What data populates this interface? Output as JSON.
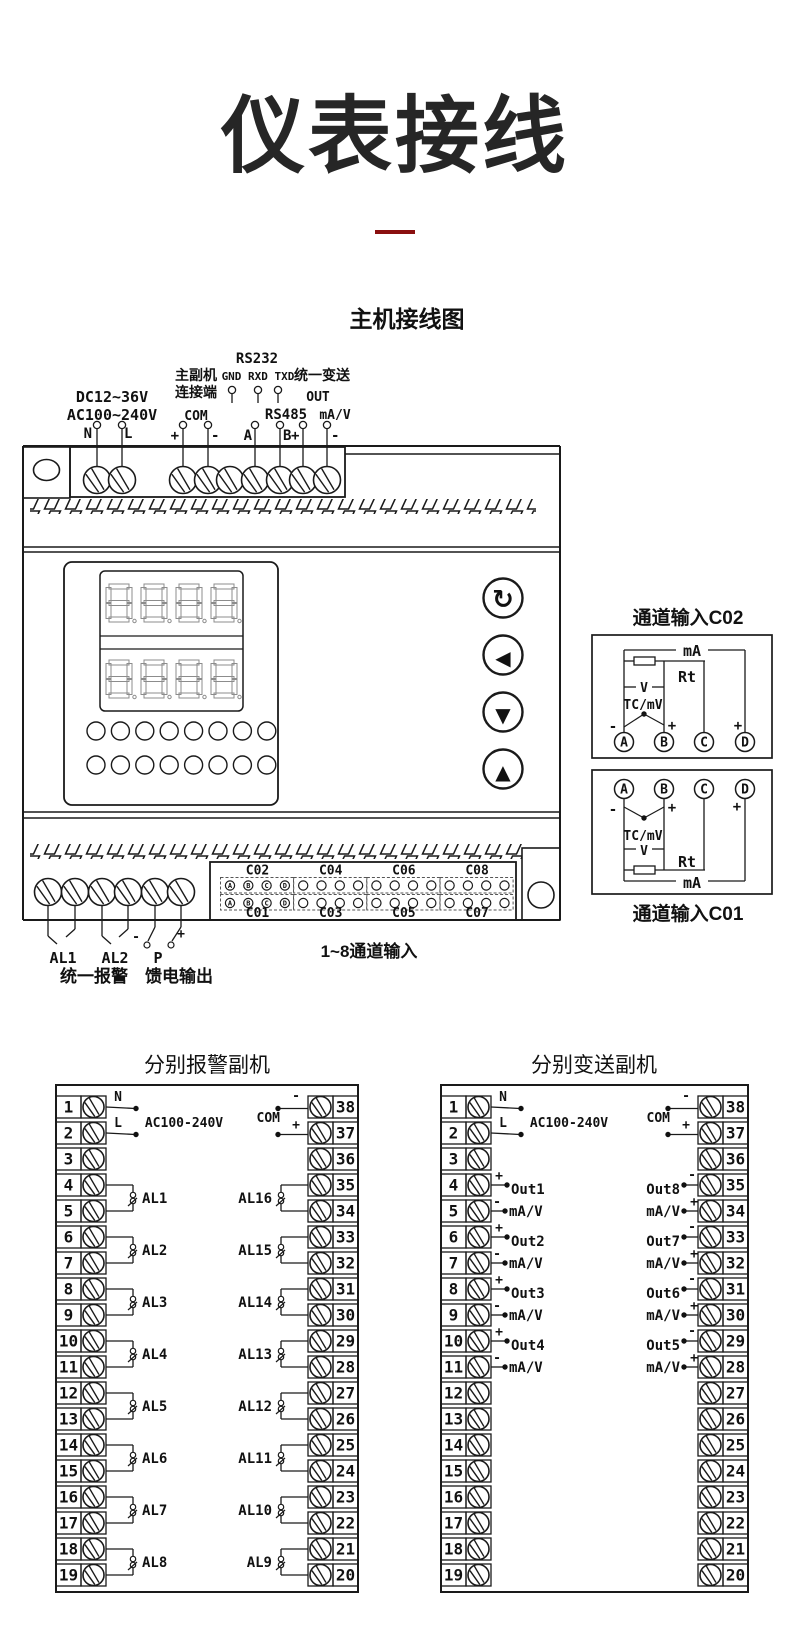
{
  "page": {
    "title": "仪表接线",
    "accent_color": "#8a0f0f"
  },
  "main": {
    "subtitle": "主机接线图",
    "top": {
      "rs232": "RS232",
      "link1": "主副机",
      "link2": "连接端",
      "gnd": "GND RXD TXD",
      "unified": "统一变送",
      "dc": "DC12~36V",
      "out": "OUT",
      "ac": "AC100~240V",
      "com": "COM",
      "rs485": "RS485",
      "mav": "mA/V",
      "pin_n": "N",
      "pin_l": "L",
      "pin_plus": "+",
      "pin_minus": "-",
      "pin_a": "A",
      "pin_b": "B",
      "pin_plus2": "+",
      "pin_minus2": "-"
    },
    "buttons": {
      "cycle": "↻",
      "left": "◀",
      "down": "▼",
      "up": "▲"
    },
    "connector": {
      "top_groups": [
        "C02",
        "C04",
        "C06",
        "C08"
      ],
      "bottom_groups": [
        "C01",
        "C03",
        "C05",
        "C07"
      ],
      "pins": [
        "A",
        "B",
        "C",
        "D"
      ],
      "caption": "1~8通道输入"
    },
    "bottom": {
      "al1": "AL1",
      "al2": "AL2",
      "p": "P",
      "minus": "-",
      "plus": "+",
      "alarm_caption": "统一报警",
      "feed_caption": "馈电输出"
    }
  },
  "channel_c02": {
    "title": "通道输入C02",
    "ma": "mA",
    "rt": "Rt",
    "v": "V",
    "tc": "TC/mV",
    "minus": "-",
    "plus": "+",
    "plus_right": "+",
    "pins": [
      "A",
      "B",
      "C",
      "D"
    ]
  },
  "channel_c01": {
    "title": "通道输入C01",
    "ma": "mA",
    "rt": "Rt",
    "v": "V",
    "tc": "TC/mV",
    "minus": "-",
    "plus": "+",
    "plus_right": "+",
    "pins": [
      "A",
      "B",
      "C",
      "D"
    ]
  },
  "alarm_unit": {
    "title": "分别报警副机",
    "n": "N",
    "l": "L",
    "ac": "AC100-240V",
    "com": "COM",
    "minus": "-",
    "plus": "+",
    "left_numbers": [
      1,
      2,
      3,
      4,
      5,
      6,
      7,
      8,
      9,
      10,
      11,
      12,
      13,
      14,
      15,
      16,
      17,
      18,
      19
    ],
    "right_numbers": [
      38,
      37,
      36,
      35,
      34,
      33,
      32,
      31,
      30,
      29,
      28,
      27,
      26,
      25,
      24,
      23,
      22,
      21,
      20
    ],
    "left_relays": [
      "AL1",
      "AL2",
      "AL3",
      "AL4",
      "AL5",
      "AL6",
      "AL7",
      "AL8"
    ],
    "right_relays": [
      "AL16",
      "AL15",
      "AL14",
      "AL13",
      "AL12",
      "AL11",
      "AL10",
      "AL9"
    ]
  },
  "transmit_unit": {
    "title": "分别变送副机",
    "n": "N",
    "l": "L",
    "ac": "AC100-240V",
    "com": "COM",
    "minus": "-",
    "plus": "+",
    "signal": "mA/V",
    "left_numbers": [
      1,
      2,
      3,
      4,
      5,
      6,
      7,
      8,
      9,
      10,
      11,
      12,
      13,
      14,
      15,
      16,
      17,
      18,
      19
    ],
    "right_numbers": [
      38,
      37,
      36,
      35,
      34,
      33,
      32,
      31,
      30,
      29,
      28,
      27,
      26,
      25,
      24,
      23,
      22,
      21,
      20
    ],
    "left_outputs": [
      "Out1",
      "Out2",
      "Out3",
      "Out4"
    ],
    "right_outputs": [
      "Out8",
      "Out7",
      "Out6",
      "Out5"
    ]
  }
}
